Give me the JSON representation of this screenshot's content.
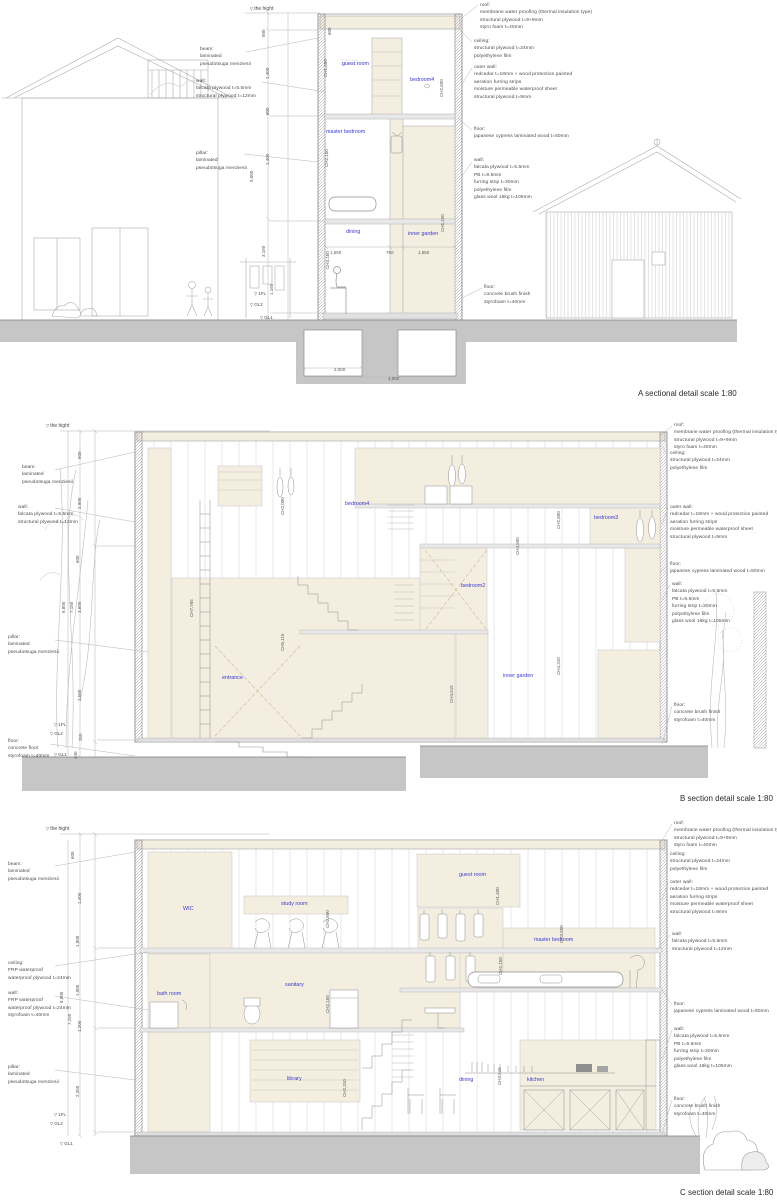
{
  "document": {
    "type": "architectural sectional detail drawings",
    "scale": "1:80"
  },
  "colors": {
    "room_fill": "#f4eee0",
    "ground": "#c6c6c6",
    "linework": "#9a9a9a",
    "room_label": "#3a3ad0",
    "background": "#ffffff"
  },
  "sections": [
    {
      "id": "A",
      "labels": [
        {
          "n": "height-marker",
          "t": "the hight",
          "x": 250,
          "y": 6,
          "c": "marker"
        },
        {
          "n": "beam-note",
          "t": "beam:\nlaminated\npseudotsuga menziesii",
          "x": 200,
          "y": 46,
          "c": "note"
        },
        {
          "n": "wall-note",
          "t": "wall:\nfalcata plywood t=5.5mm\nstructural plywood t=12mm",
          "x": 196,
          "y": 78,
          "c": "note"
        },
        {
          "n": "pillar-note",
          "t": "pillar:\nlaminated\npseudotsuga menziesii",
          "x": 196,
          "y": 150,
          "c": "note"
        },
        {
          "n": "roof-note",
          "t": "roof:\nmembrane water proofing (thermal insulation type)\nstructural plywood t=9+9mm\nstyro foam t=40mm",
          "x": 480,
          "y": 2,
          "c": "note"
        },
        {
          "n": "ceiling-note",
          "t": "ceiling:\nstructural plywood t=24mm\npolyethylene film",
          "x": 474,
          "y": 38,
          "c": "note"
        },
        {
          "n": "outer-wall-note",
          "t": "outer wall:\nredcedar t=18mm + wood protection painted\naeration furring strips\nmoisture permeable waterproof sheet\nstructural plywood t=9mm",
          "x": 474,
          "y": 64,
          "c": "note"
        },
        {
          "n": "floor-note",
          "t": "floor:\njapanese cypress laminated wood t=50mm",
          "x": 474,
          "y": 126,
          "c": "note"
        },
        {
          "n": "inner-wall-note",
          "t": "wall:\nfalcata plywood t=5.5mm\nPB t=9.5mm\nfurring strip t=30mm\npolyethylene film\nglass wool 16kg t=105mm",
          "x": 474,
          "y": 157,
          "c": "note"
        },
        {
          "n": "ground-floor-note",
          "t": "floor:\nconcrete brush finish\nstyrofoam t=40mm",
          "x": 484,
          "y": 284,
          "c": "note"
        },
        {
          "n": "room-label-guest-room",
          "t": "guest room",
          "x": 342,
          "y": 60,
          "c": "room"
        },
        {
          "n": "room-label-bedroom4",
          "t": "bedroom4",
          "x": 410,
          "y": 76,
          "c": "room"
        },
        {
          "n": "room-label-master-bedroom",
          "t": "master bedroom",
          "x": 326,
          "y": 128,
          "c": "room"
        },
        {
          "n": "room-label-dining",
          "t": "dining",
          "x": 346,
          "y": 228,
          "c": "room"
        },
        {
          "n": "room-label-inner-garden",
          "t": "inner garden",
          "x": 408,
          "y": 230,
          "c": "room"
        },
        {
          "n": "ch-dim",
          "t": "CH1,400",
          "x": 330,
          "y": 70,
          "c": "dimv"
        },
        {
          "n": "ch-dim",
          "t": "CH2,600",
          "x": 446,
          "y": 90,
          "c": "dimv"
        },
        {
          "n": "ch-dim",
          "t": "CH2,150",
          "x": 331,
          "y": 160,
          "c": "dimv"
        },
        {
          "n": "ch-dim",
          "t": "CH3,150",
          "x": 332,
          "y": 262,
          "c": "dimv"
        },
        {
          "n": "ch-dim",
          "t": "CH5,150",
          "x": 447,
          "y": 225,
          "c": "dimv"
        },
        {
          "n": "dim",
          "t": "600",
          "x": 268,
          "y": 30,
          "c": "dimv"
        },
        {
          "n": "dim",
          "t": "600",
          "x": 334,
          "y": 28,
          "c": "dimv"
        },
        {
          "n": "dim",
          "t": "1,400",
          "x": 272,
          "y": 72,
          "c": "dimv"
        },
        {
          "n": "dim",
          "t": "600",
          "x": 272,
          "y": 108,
          "c": "dimv"
        },
        {
          "n": "dim",
          "t": "1,400",
          "x": 272,
          "y": 158,
          "c": "dimv"
        },
        {
          "n": "dim",
          "t": "9,000",
          "x": 256,
          "y": 175,
          "c": "dimv"
        },
        {
          "n": "dim",
          "t": "3,160",
          "x": 268,
          "y": 250,
          "c": "dimv"
        },
        {
          "n": "dim",
          "t": "1,160",
          "x": 276,
          "y": 288,
          "c": "dimv"
        },
        {
          "n": "dim",
          "t": "1,550",
          "x": 330,
          "y": 250,
          "c": "dim"
        },
        {
          "n": "dim",
          "t": "760",
          "x": 386,
          "y": 250,
          "c": "dim"
        },
        {
          "n": "dim",
          "t": "1,550",
          "x": 418,
          "y": 250,
          "c": "dim"
        },
        {
          "n": "dim",
          "t": "2,000",
          "x": 334,
          "y": 367,
          "c": "dim"
        },
        {
          "n": "dim",
          "t": "4,000",
          "x": 388,
          "y": 376,
          "c": "dim"
        },
        {
          "n": "level-1fl",
          "t": "1FL",
          "x": 254,
          "y": 291,
          "c": "lvl"
        },
        {
          "n": "level-gl2",
          "t": "GL2",
          "x": 250,
          "y": 302,
          "c": "lvl"
        },
        {
          "n": "level-gl1",
          "t": "GL1",
          "x": 260,
          "y": 315,
          "c": "lvl"
        },
        {
          "n": "section-title",
          "t": "A sectional detail scale 1:80",
          "x": 638,
          "y": 388,
          "c": "title"
        }
      ]
    },
    {
      "id": "B",
      "labels": [
        {
          "n": "height-marker",
          "t": "the hight",
          "x": 46,
          "y": 423,
          "c": "marker"
        },
        {
          "n": "beam-note",
          "t": "beam:\nlaminated\npseudotsuga menziesii",
          "x": 22,
          "y": 464,
          "c": "note"
        },
        {
          "n": "wall-note",
          "t": "wall:\nfalcata plywood t=5.5mm\nstructural plywood t=12mm",
          "x": 18,
          "y": 504,
          "c": "note"
        },
        {
          "n": "pillar-note",
          "t": "pillar:\nlaminated\npseudotsuga menziesii",
          "x": 8,
          "y": 634,
          "c": "note"
        },
        {
          "n": "floor-note",
          "t": "floor:\nconcrete floor\nstyrofoam t=40mm",
          "x": 8,
          "y": 738,
          "c": "note"
        },
        {
          "n": "roof-note",
          "t": "roof:\nmembrane water proofing (thermal insulation type)\nstructural plywood t=9+9mm\nstyro foam t=40mm",
          "x": 674,
          "y": 422,
          "c": "note"
        },
        {
          "n": "ceiling-note",
          "t": "ceiling:\nstructural plywood t=24mm\npolyethylene film",
          "x": 670,
          "y": 450,
          "c": "note"
        },
        {
          "n": "outer-wall-note",
          "t": "outer wall:\nredcedar t=18mm + wood protection painted\naeration furring strips\nmoisture permeable waterproof sheet\nstructural plywood t=9mm",
          "x": 670,
          "y": 504,
          "c": "note"
        },
        {
          "n": "floor-note-2",
          "t": "floor:\njapanese cypress laminated wood t=50mm",
          "x": 670,
          "y": 561,
          "c": "note"
        },
        {
          "n": "inner-wall-note",
          "t": "wall:\nfalcata plywood t=5.5mm\nPB t=9.5mm\nfurring strip t=30mm\npolyethylene film\nglass wool 16kg t=105mm",
          "x": 672,
          "y": 581,
          "c": "note"
        },
        {
          "n": "ground-floor-note",
          "t": "floor:\nconcrete brush finish\nstyrofoam t=40mm",
          "x": 674,
          "y": 702,
          "c": "note"
        },
        {
          "n": "room-label-bedroom4",
          "t": "bedroom4",
          "x": 345,
          "y": 500,
          "c": "room"
        },
        {
          "n": "room-label-bedroom3",
          "t": "bedroom3",
          "x": 594,
          "y": 514,
          "c": "room"
        },
        {
          "n": "room-label-bedroom2",
          "t": "bedroom2",
          "x": 461,
          "y": 582,
          "c": "room"
        },
        {
          "n": "room-label-entrance",
          "t": "entrance",
          "x": 222,
          "y": 674,
          "c": "room"
        },
        {
          "n": "room-label-inner-garden",
          "t": "inner garden",
          "x": 503,
          "y": 672,
          "c": "room"
        },
        {
          "n": "ch-dim",
          "t": "CH2,000",
          "x": 287,
          "y": 508,
          "c": "dimv"
        },
        {
          "n": "ch-dim",
          "t": "CH2,600",
          "x": 563,
          "y": 522,
          "c": "dimv"
        },
        {
          "n": "ch-dim",
          "t": "CH4,500",
          "x": 522,
          "y": 548,
          "c": "dimv"
        },
        {
          "n": "ch-dim",
          "t": "CH7,765",
          "x": 196,
          "y": 610,
          "c": "dimv"
        },
        {
          "n": "ch-dim",
          "t": "CH5,115",
          "x": 287,
          "y": 644,
          "c": "dimv"
        },
        {
          "n": "ch-dim",
          "t": "CH4,310",
          "x": 563,
          "y": 668,
          "c": "dimv"
        },
        {
          "n": "ch-dim",
          "t": "CH4,515",
          "x": 456,
          "y": 696,
          "c": "dimv"
        },
        {
          "n": "dim",
          "t": "600",
          "x": 84,
          "y": 452,
          "c": "dimv"
        },
        {
          "n": "dim",
          "t": "2,900",
          "x": 84,
          "y": 502,
          "c": "dimv"
        },
        {
          "n": "dim",
          "t": "600",
          "x": 82,
          "y": 556,
          "c": "dimv"
        },
        {
          "n": "dim",
          "t": "8,800",
          "x": 68,
          "y": 606,
          "c": "dimv"
        },
        {
          "n": "dim",
          "t": "7,150",
          "x": 76,
          "y": 606,
          "c": "dimv"
        },
        {
          "n": "dim",
          "t": "3,600",
          "x": 84,
          "y": 606,
          "c": "dimv"
        },
        {
          "n": "dim",
          "t": "2,560",
          "x": 84,
          "y": 694,
          "c": "dimv"
        },
        {
          "n": "dim",
          "t": "350",
          "x": 85,
          "y": 734,
          "c": "dimv"
        },
        {
          "n": "dim",
          "t": "440",
          "x": 80,
          "y": 752,
          "c": "dimv"
        },
        {
          "n": "level-1fl",
          "t": "1FL",
          "x": 54,
          "y": 722,
          "c": "lvl"
        },
        {
          "n": "level-gl2",
          "t": "GL2",
          "x": 50,
          "y": 731,
          "c": "lvl"
        },
        {
          "n": "level-gl1",
          "t": "GL1",
          "x": 54,
          "y": 752,
          "c": "lvl"
        },
        {
          "n": "section-title",
          "t": "B section detail scale 1:80",
          "x": 680,
          "y": 793,
          "c": "title"
        }
      ]
    },
    {
      "id": "C",
      "labels": [
        {
          "n": "height-marker",
          "t": "the hight",
          "x": 46,
          "y": 826,
          "c": "marker"
        },
        {
          "n": "beam-note",
          "t": "beam:\nlaminated\npseudotsuga menziesii",
          "x": 8,
          "y": 861,
          "c": "note"
        },
        {
          "n": "ceiling-note-left",
          "t": "ceiling:\nFRP waterproof\nwaterproof plywood t=24mm",
          "x": 8,
          "y": 960,
          "c": "note"
        },
        {
          "n": "wall-note-left",
          "t": "wall:\nFRP waterproof\nwaterproof plywood t=24mm\nstyrofoam t=40mm",
          "x": 8,
          "y": 990,
          "c": "note"
        },
        {
          "n": "pillar-note",
          "t": "pillar:\nlaminated\npseudotsuga menziesii",
          "x": 8,
          "y": 1064,
          "c": "note"
        },
        {
          "n": "roof-note",
          "t": "roof:\nmembrane water proofing (thermal insulation type)\nstructural plywood t=9+9mm\nstyro foam t=40mm",
          "x": 674,
          "y": 820,
          "c": "note"
        },
        {
          "n": "ceiling-note",
          "t": "ceiling:\nstructural plywood t=24mm\npolyethylene film",
          "x": 670,
          "y": 851,
          "c": "note"
        },
        {
          "n": "outer-wall-note",
          "t": "outer wall:\nredcedar t=18mm + wood protection painted\naeration furring strips\nmoisture permeable waterproof sheet\nstructural plywood t=9mm",
          "x": 670,
          "y": 879,
          "c": "note"
        },
        {
          "n": "wall-note-right",
          "t": "wall:\nfalcata plywood t=5.5mm\nstructural plywood t=12mm",
          "x": 672,
          "y": 931,
          "c": "note"
        },
        {
          "n": "floor-note",
          "t": "floor:\njapanese cypress laminated wood t=50mm",
          "x": 674,
          "y": 1001,
          "c": "note"
        },
        {
          "n": "inner-wall-note",
          "t": "wall:\nfalcata plywood t=5.5mm\nPB t=9.5mm\nfurring strip t=30mm\npolyethylene film\nglass wool 16kg t=105mm",
          "x": 674,
          "y": 1026,
          "c": "note"
        },
        {
          "n": "ground-floor-note",
          "t": "floor:\nconcrete brush finish\nstyrofoam t=40mm",
          "x": 674,
          "y": 1096,
          "c": "note"
        },
        {
          "n": "room-label-wic",
          "t": "WIC",
          "x": 183,
          "y": 905,
          "c": "room"
        },
        {
          "n": "room-label-study-room",
          "t": "study room",
          "x": 281,
          "y": 900,
          "c": "room"
        },
        {
          "n": "room-label-guest-room",
          "t": "guest room",
          "x": 459,
          "y": 871,
          "c": "room"
        },
        {
          "n": "room-label-master-bedroom",
          "t": "master bedroom",
          "x": 534,
          "y": 936,
          "c": "room"
        },
        {
          "n": "room-label-bath-room",
          "t": "bath room",
          "x": 157,
          "y": 990,
          "c": "room"
        },
        {
          "n": "room-label-sanitary",
          "t": "sanitary",
          "x": 285,
          "y": 981,
          "c": "room"
        },
        {
          "n": "room-label-library",
          "t": "library",
          "x": 287,
          "y": 1075,
          "c": "room"
        },
        {
          "n": "room-label-dining",
          "t": "dining",
          "x": 459,
          "y": 1076,
          "c": "room"
        },
        {
          "n": "room-label-kitchen",
          "t": "kitchen",
          "x": 527,
          "y": 1076,
          "c": "room"
        },
        {
          "n": "ch-dim",
          "t": "CH2,600",
          "x": 332,
          "y": 921,
          "c": "dimv"
        },
        {
          "n": "ch-dim",
          "t": "CH2,150",
          "x": 332,
          "y": 1006,
          "c": "dimv"
        },
        {
          "n": "ch-dim",
          "t": "CH1,400",
          "x": 502,
          "y": 898,
          "c": "dimv"
        },
        {
          "n": "ch-dim",
          "t": "CH3,600",
          "x": 566,
          "y": 936,
          "c": "dimv"
        },
        {
          "n": "ch-dim",
          "t": "CH2,150",
          "x": 505,
          "y": 968,
          "c": "dimv"
        },
        {
          "n": "ch-dim",
          "t": "CH3,515",
          "x": 504,
          "y": 1078,
          "c": "dimv"
        },
        {
          "n": "ch-dim",
          "t": "CH2,310",
          "x": 349,
          "y": 1090,
          "c": "dimv"
        },
        {
          "n": "dim",
          "t": "600",
          "x": 77,
          "y": 852,
          "c": "dimv"
        },
        {
          "n": "dim",
          "t": "1,400",
          "x": 84,
          "y": 897,
          "c": "dimv"
        },
        {
          "n": "dim",
          "t": "1,800",
          "x": 82,
          "y": 940,
          "c": "dimv"
        },
        {
          "n": "dim",
          "t": "1,000",
          "x": 82,
          "y": 989,
          "c": "dimv"
        },
        {
          "n": "dim",
          "t": "1,200",
          "x": 84,
          "y": 1025,
          "c": "dimv"
        },
        {
          "n": "dim",
          "t": "2,350",
          "x": 82,
          "y": 1090,
          "c": "dimv"
        },
        {
          "n": "dim",
          "t": "8,800",
          "x": 66,
          "y": 996,
          "c": "dimv"
        },
        {
          "n": "dim",
          "t": "7,150",
          "x": 74,
          "y": 1018,
          "c": "dimv"
        },
        {
          "n": "level-1fl",
          "t": "1FL",
          "x": 54,
          "y": 1112,
          "c": "lvl"
        },
        {
          "n": "level-gl2",
          "t": "GL2",
          "x": 50,
          "y": 1121,
          "c": "lvl"
        },
        {
          "n": "level-gl1",
          "t": "GL1",
          "x": 60,
          "y": 1141,
          "c": "lvl"
        },
        {
          "n": "section-title",
          "t": "C section detail scale 1:80",
          "x": 680,
          "y": 1187,
          "c": "title"
        }
      ]
    }
  ]
}
